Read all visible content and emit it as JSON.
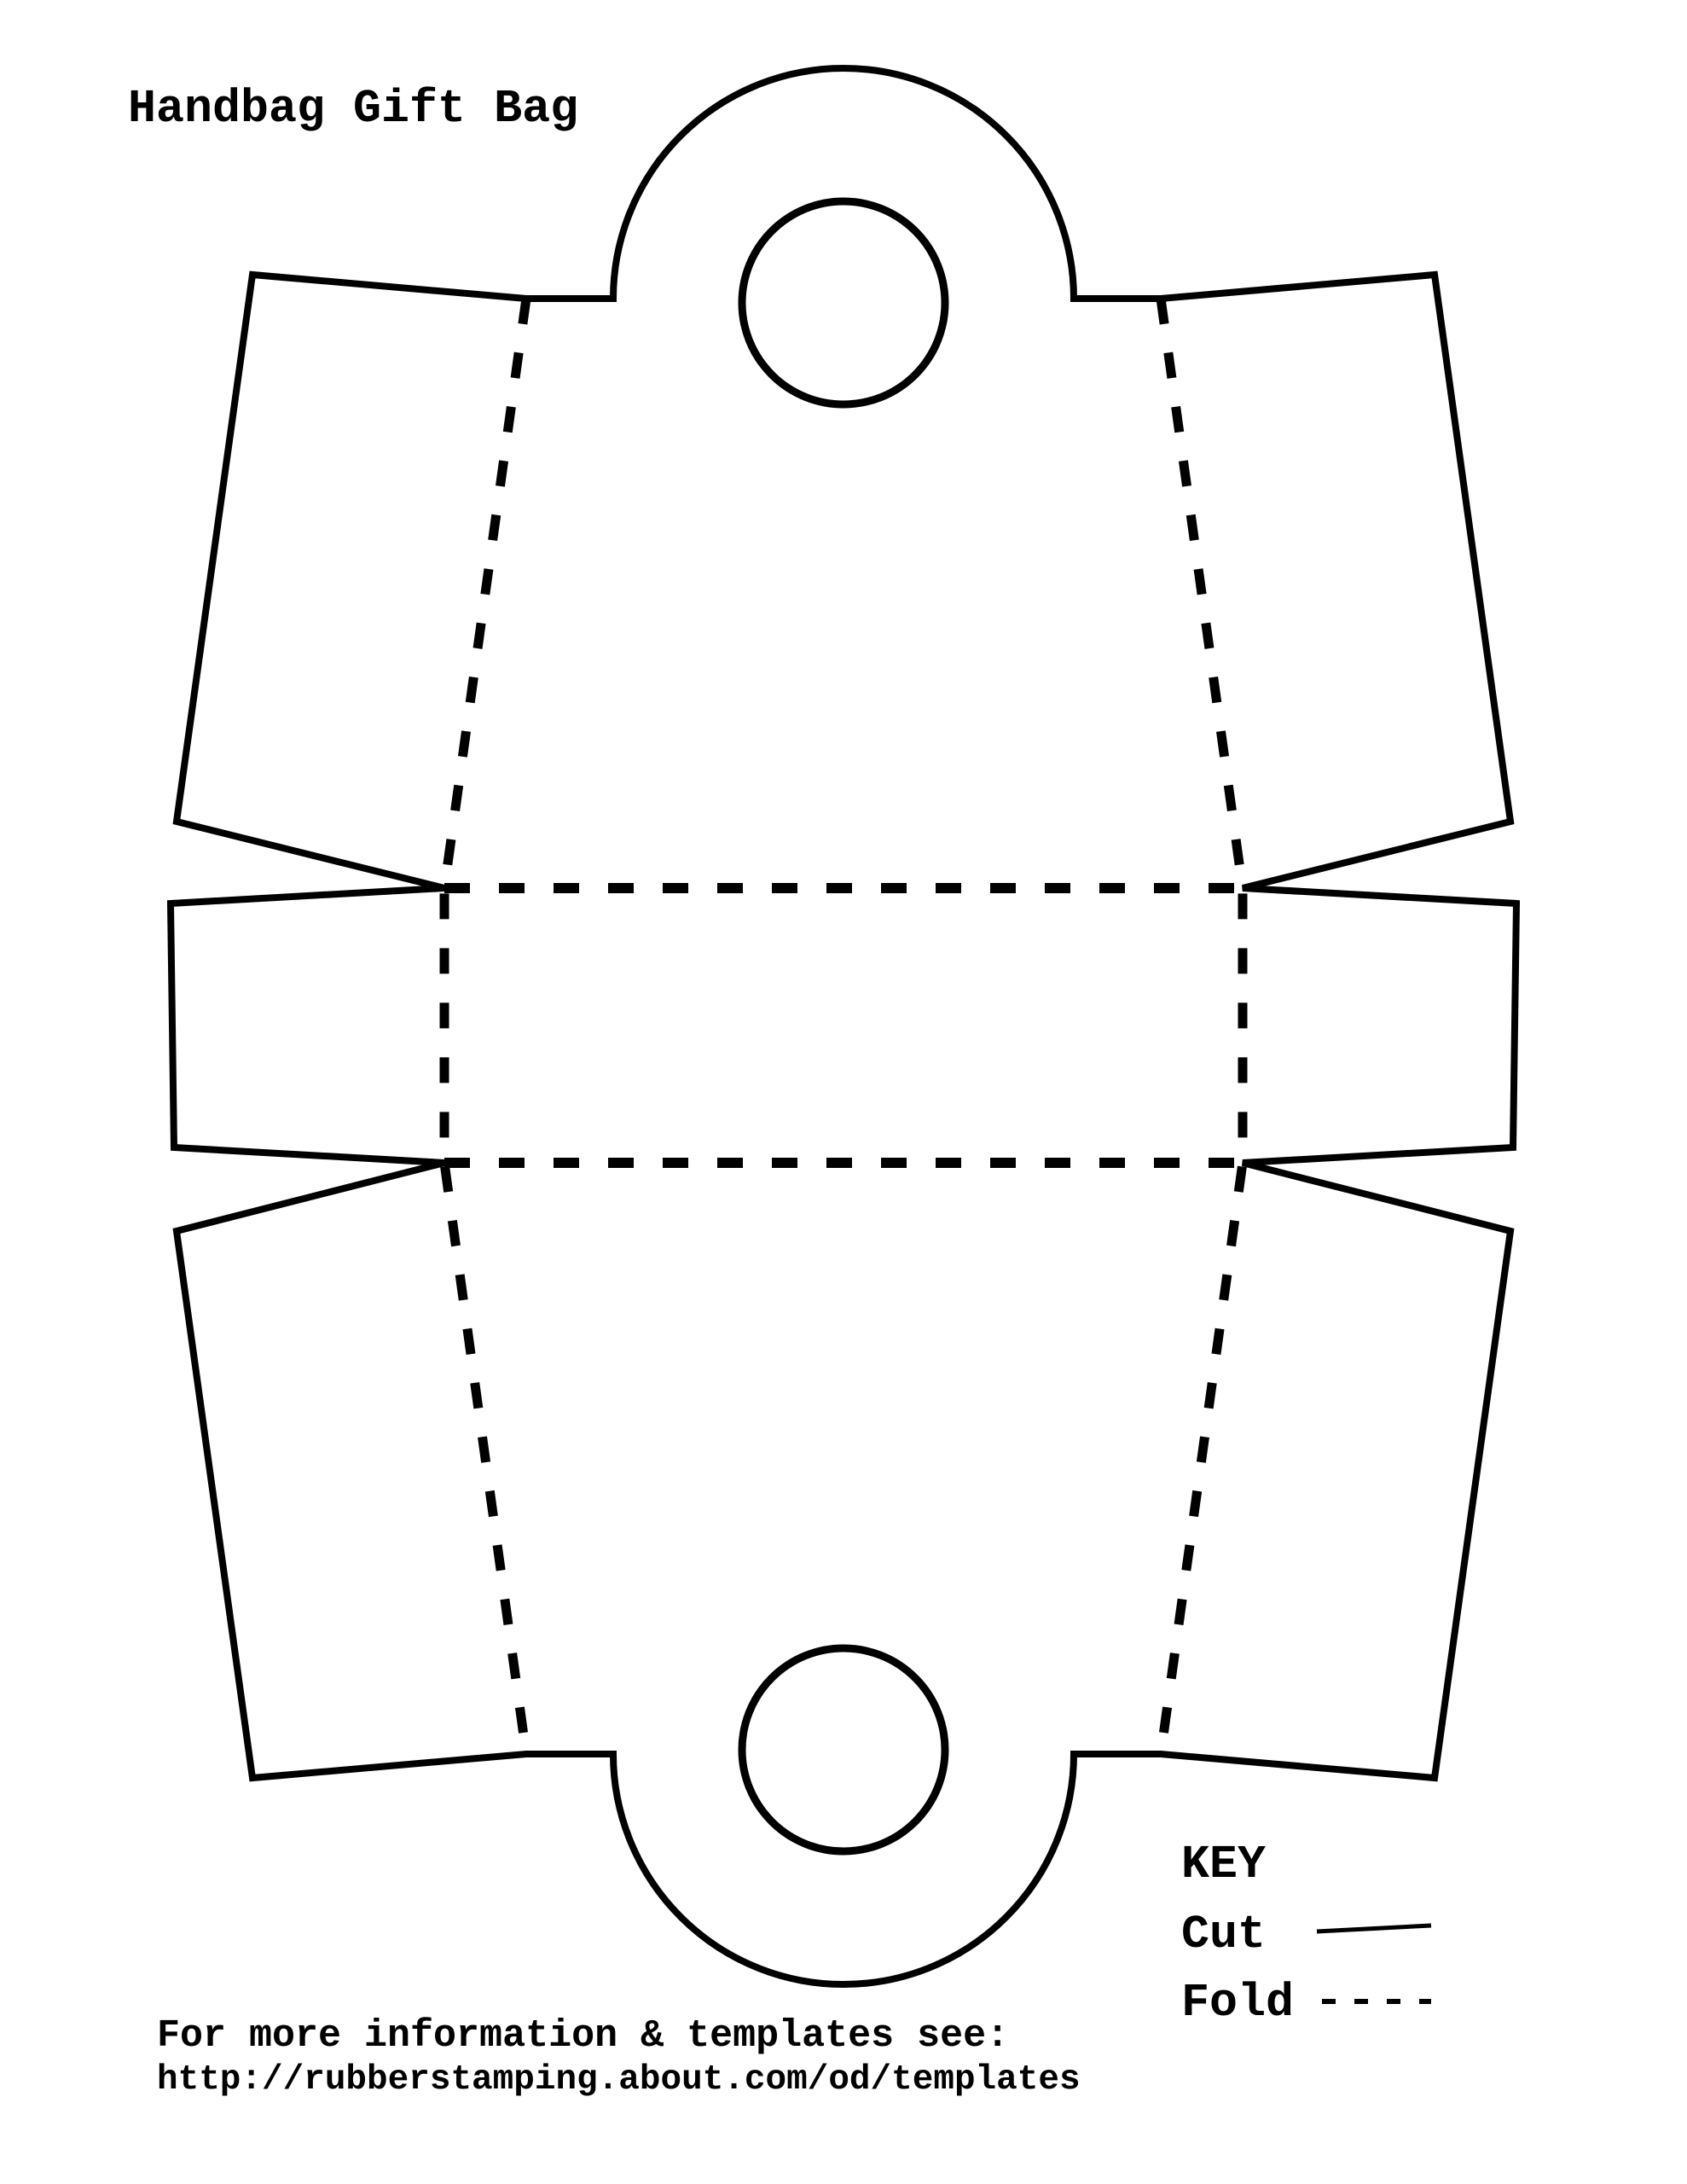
{
  "page": {
    "title": "Handbag Gift Bag",
    "footer": {
      "line1": "For more information & templates see:",
      "line2": "http://rubberstamping.about.com/od/templates"
    }
  },
  "legend": {
    "heading": "KEY",
    "cut_label": "Cut",
    "fold_label": "Fold",
    "cut_line_style": "solid",
    "fold_line_style": "dashed"
  },
  "drawing": {
    "line_color": "#000000",
    "paper_color": "#ffffff"
  }
}
